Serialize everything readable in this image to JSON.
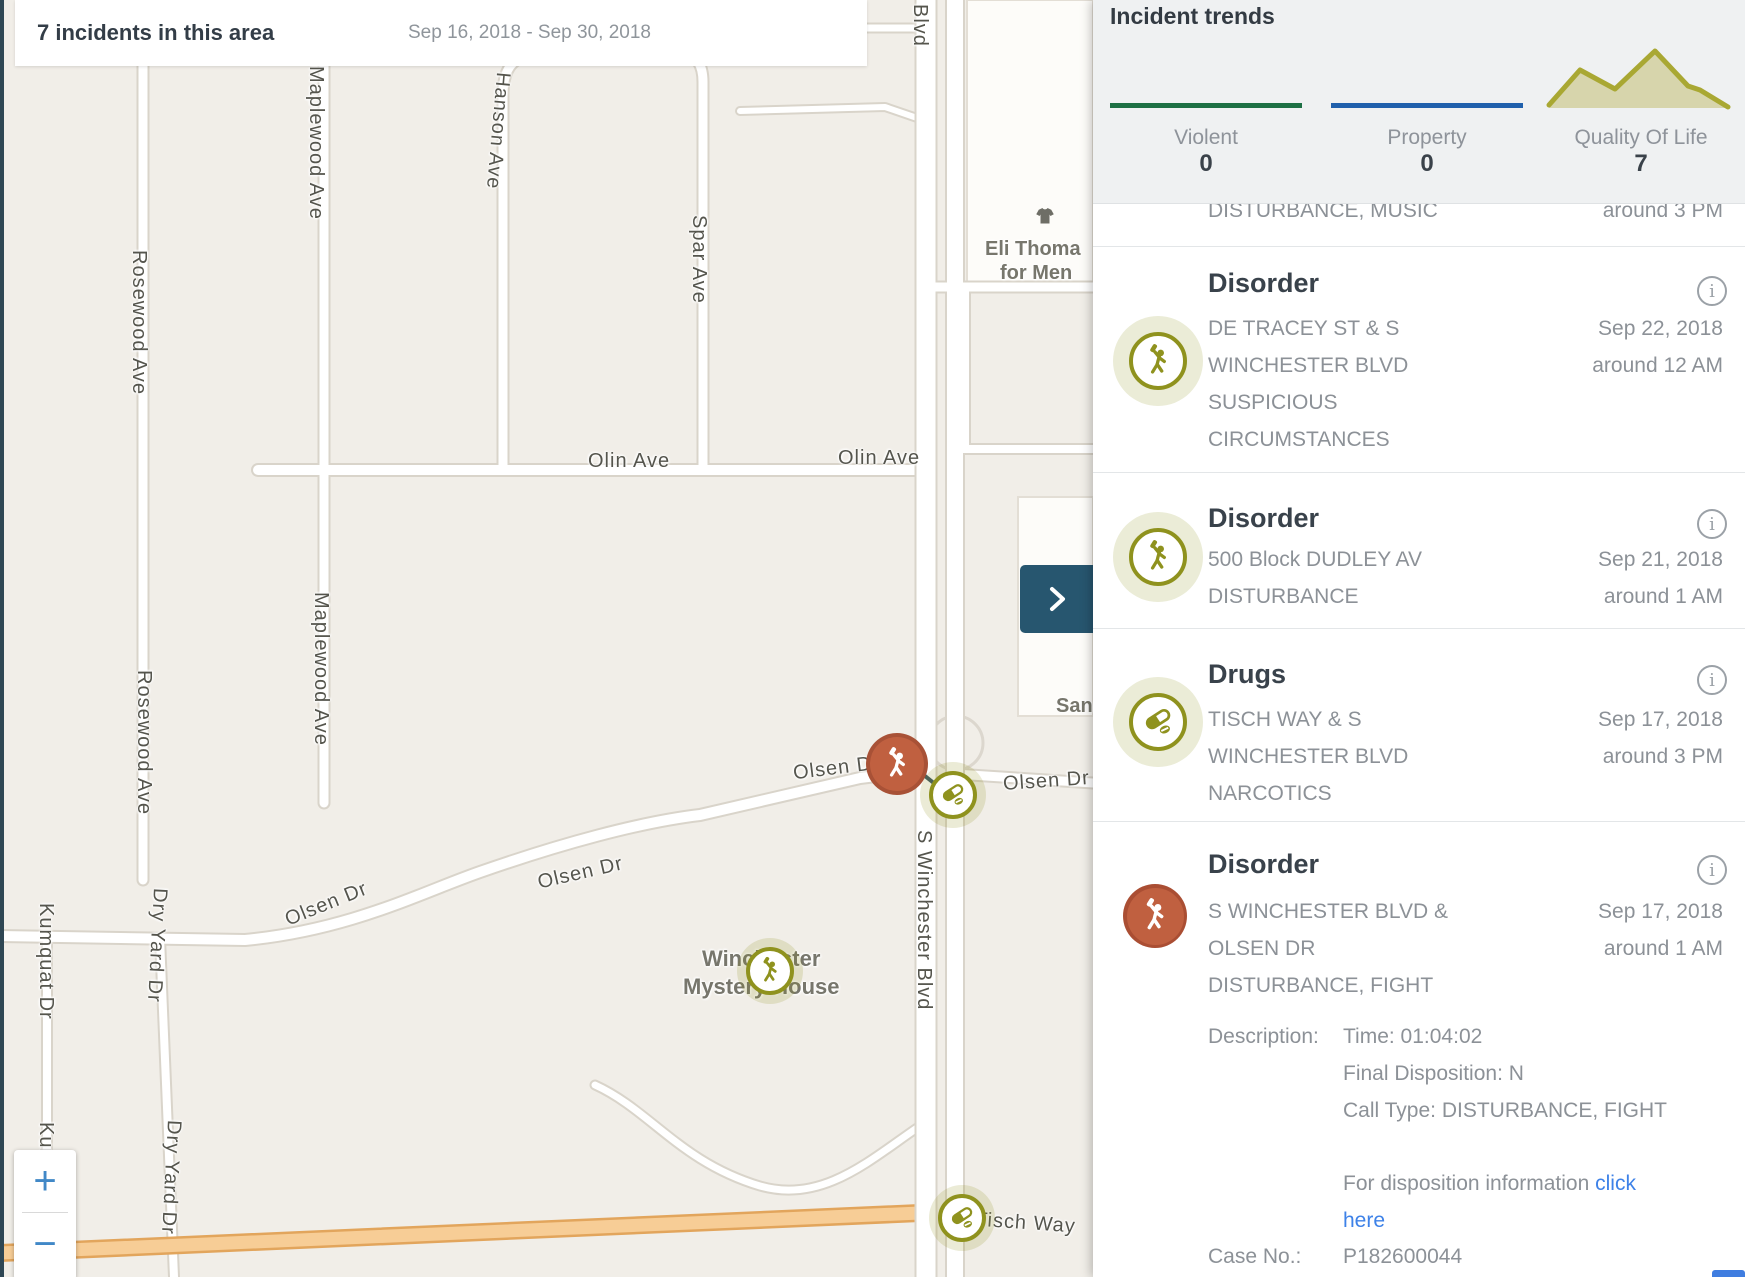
{
  "header": {
    "title": "7 incidents in this area",
    "date_range": "Sep 16, 2018 - Sep 30, 2018"
  },
  "panel": {
    "title": "Incident trends",
    "trends": [
      {
        "label": "Violent",
        "value": "0",
        "color": "#1d7044",
        "type": "line"
      },
      {
        "label": "Property",
        "value": "0",
        "color": "#2060ac",
        "type": "line"
      },
      {
        "label": "Quality Of Life",
        "value": "7",
        "color": "#a9a833",
        "type": "area"
      }
    ],
    "partial_item": {
      "address": "DISTURBANCE, MUSIC",
      "time": "around 3 PM"
    },
    "incidents": [
      {
        "type": "Disorder",
        "icon": "disorder-icon",
        "address_lines": [
          "DE TRACEY ST & S",
          "WINCHESTER BLVD",
          "SUSPICIOUS",
          "CIRCUMSTANCES"
        ],
        "date": "Sep 22, 2018",
        "time": "around 12 AM"
      },
      {
        "type": "Disorder",
        "icon": "disorder-icon",
        "address_lines": [
          "500 Block DUDLEY AV",
          "DISTURBANCE"
        ],
        "date": "Sep 21, 2018",
        "time": "around 1 AM"
      },
      {
        "type": "Drugs",
        "icon": "drugs-icon",
        "address_lines": [
          "TISCH WAY & S",
          "WINCHESTER BLVD",
          "NARCOTICS"
        ],
        "date": "Sep 17, 2018",
        "time": "around 3 PM"
      },
      {
        "type": "Disorder",
        "icon": "disorder-selected-icon",
        "address_lines": [
          "S WINCHESTER BLVD &",
          "OLSEN DR",
          "DISTURBANCE, FIGHT"
        ],
        "date": "Sep 17, 2018",
        "time": "around 1 AM",
        "details": {
          "description_label": "Description:",
          "time_row": "Time: 01:04:02",
          "final_disposition_row": "Final Disposition: N",
          "call_type_row": "Call Type: DISTURBANCE, FIGHT",
          "disposition_text": "For disposition information ",
          "link_word1": "click",
          "link_word2": "here",
          "case_label": "Case No.:",
          "case_value": "P182600044"
        }
      }
    ]
  },
  "map": {
    "street_labels": [
      {
        "text": "Blvd"
      },
      {
        "text": "Maplewood Ave"
      },
      {
        "text": "Maplewood Ave"
      },
      {
        "text": "Rosewood Ave"
      },
      {
        "text": "Rosewood Ave"
      },
      {
        "text": "Hanson Ave"
      },
      {
        "text": "Spar Ave"
      },
      {
        "text": "Olin Ave"
      },
      {
        "text": "Olin Ave"
      },
      {
        "text": "Olsen Dr"
      },
      {
        "text": "Olsen Dr"
      },
      {
        "text": "Olsen Dr"
      },
      {
        "text": "Olsen Dr"
      },
      {
        "text": "S Winchester Blvd"
      },
      {
        "text": "Tisch Way"
      },
      {
        "text": "Kumquat Dr"
      },
      {
        "text": "Kumquat Dr"
      },
      {
        "text": "Dry Yard Dr"
      },
      {
        "text": "Dry Yard Dr"
      }
    ],
    "pois": {
      "eli_line1": "Eli Thoma",
      "eli_line2": "for Men",
      "san": "San",
      "mystery_line1": "Winchester",
      "mystery_line2": "Mystery House"
    },
    "markers": [
      {
        "type": "disorder",
        "state": "selected"
      },
      {
        "type": "drugs",
        "state": "normal"
      },
      {
        "type": "disorder",
        "state": "normal"
      },
      {
        "type": "drugs",
        "state": "normal"
      }
    ],
    "controls": {
      "zoom_in": "+",
      "zoom_out": "−"
    }
  },
  "colors": {
    "olive": "#8f921e",
    "olive_halo": "#ebecd7",
    "red_marker": "#c06040",
    "red_ring": "#a85136",
    "green_trend": "#1d7044",
    "blue_trend": "#2060ac",
    "sparkline": "#a9a833",
    "link_blue": "#3e82e8",
    "teal_button": "#27566f",
    "map_bg": "#f1eee8"
  }
}
